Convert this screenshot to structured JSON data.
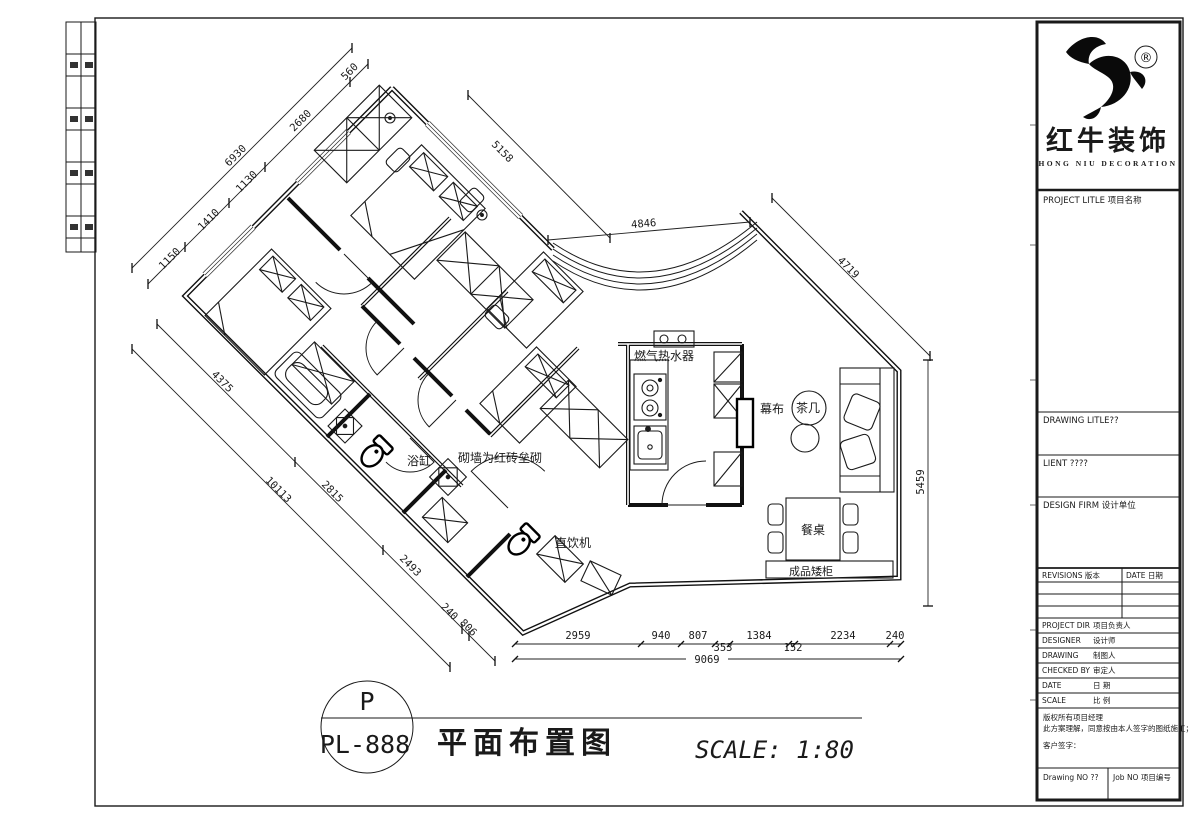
{
  "brand": {
    "name_cn": "红牛装饰",
    "name_en": "HONG NIU DECORATION",
    "reg": "®"
  },
  "title_block": {
    "project_title": "PROJECT LITLE 项目名称",
    "drawing_title": "DRAWING LITLE??",
    "client": "LIENT ????",
    "design_firm": "DESIGN FIRM 设计单位",
    "revisions": "REVISIONS 版本",
    "date_col": "DATE 日期",
    "project_dir_label": "PROJECT DIR",
    "project_dir_value": "项目负责人",
    "designer_label": "DESIGNER",
    "designer_value": "设计师",
    "drawing_label": "DRAWING",
    "drawing_value": "制图人",
    "checked_label": "CHECKED BY",
    "checked_value": "审定人",
    "date_label": "DATE",
    "date_value": "日 期",
    "scale_label": "SCALE",
    "scale_value": "比 例",
    "note1": "版权所有项目经理",
    "note2": "此方案理解，同意按由本人签字的图纸施工；",
    "note3": "客户签字：",
    "drawing_no": "Drawing NO ??",
    "job_no": "Job NO 项目编号"
  },
  "footer": {
    "badge_letter": "P",
    "badge_code": "PL-888",
    "sheet_title": "平面布置图",
    "scale_note": "SCALE: 1:80"
  },
  "rooms": {
    "gas_heater": "燃气热水器",
    "curtain": "幕布",
    "tea_table": "茶几",
    "dining_table": "餐桌",
    "cabinet": "成品矮柜",
    "bathtub": "浴缸",
    "brick_note": "砌墙为红砖垒砌",
    "water": "直饮机"
  },
  "dims": {
    "d560": "560",
    "d2680": "2680",
    "d6930": "6930",
    "d1130": "1130",
    "d1410": "1410",
    "d1150": "1150",
    "d4375": "4375",
    "d10113": "10113",
    "d2815": "2815",
    "d2493": "2493",
    "d240l": "240",
    "d806": "806",
    "d5158": "5158",
    "d4846": "4846",
    "d4719": "4719",
    "d5459": "5459",
    "b1": "2959",
    "b2": "940",
    "b3": "807",
    "b4": "353",
    "b5": "1384",
    "b6": "152",
    "b7": "2234",
    "b8": "240",
    "total": "9069"
  }
}
